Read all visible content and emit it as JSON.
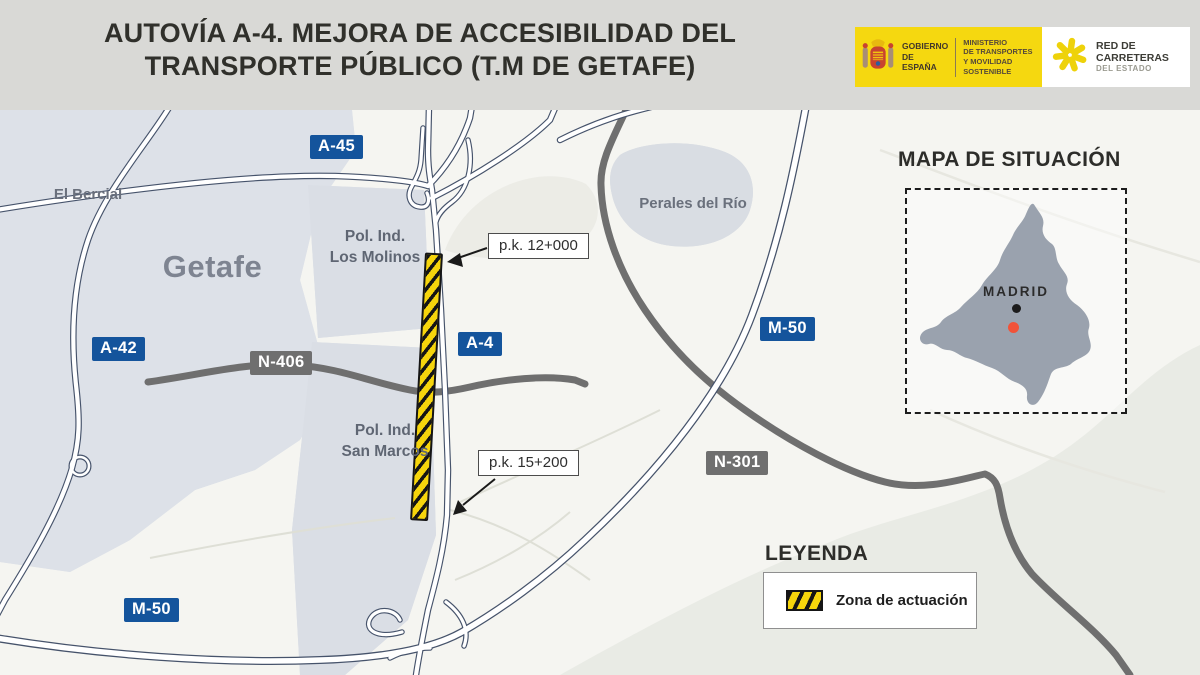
{
  "header": {
    "title": {
      "line1": "AUTOVÍA A-4. MEJORA DE ACCESIBILIDAD DEL",
      "line2": "TRANSPORTE PÚBLICO (T.M DE GETAFE)"
    },
    "gov": {
      "line1": "GOBIERNO",
      "line2": "DE ESPAÑA",
      "ministry1": "MINISTERIO",
      "ministry2": "DE TRANSPORTES",
      "ministry3": "Y MOVILIDAD SOSTENIBLE"
    },
    "network": {
      "line1": "RED DE",
      "line2": "CARRETERAS",
      "line3": "DEL ESTADO"
    }
  },
  "map": {
    "badges": {
      "a45": "A-45",
      "a42": "A-42",
      "a4": "A-4",
      "m50_east": "M-50",
      "m50_south": "M-50",
      "n406": "N-406",
      "n301": "N-301"
    },
    "places": {
      "el_bercial": "El Bercial",
      "getafe": "Getafe",
      "molinos_line1": "Pol. Ind.",
      "molinos_line2": "Los Molinos",
      "san_marcos_line1": "Pol. Ind.",
      "san_marcos_line2": "San Marcos",
      "perales": "Perales del Río"
    },
    "callouts": {
      "pk12": "p.k. 12+000",
      "pk15": "p.k. 15+200"
    }
  },
  "inset": {
    "title": "MAPA DE SITUACIÓN",
    "city": "MADRID"
  },
  "legend": {
    "title": "LEYENDA",
    "zone_label": "Zona de actuación"
  },
  "colors": {
    "header_bg": "#d9d9d6",
    "badge_blue": "#14549c",
    "badge_gray": "#6f6f6f",
    "motorway_casing": "#46536b",
    "national_road_gray": "#6f6f6f",
    "work_zone_yellow": "#f6d50c",
    "work_zone_stripe": "#151515",
    "urban_area": "#dde1e8",
    "madrid_region_gray": "#9aa2ae",
    "madrid_dot_black": "#1c1c1c",
    "location_dot_red": "#f15339",
    "gov_logo_yellow": "#f5d810"
  }
}
